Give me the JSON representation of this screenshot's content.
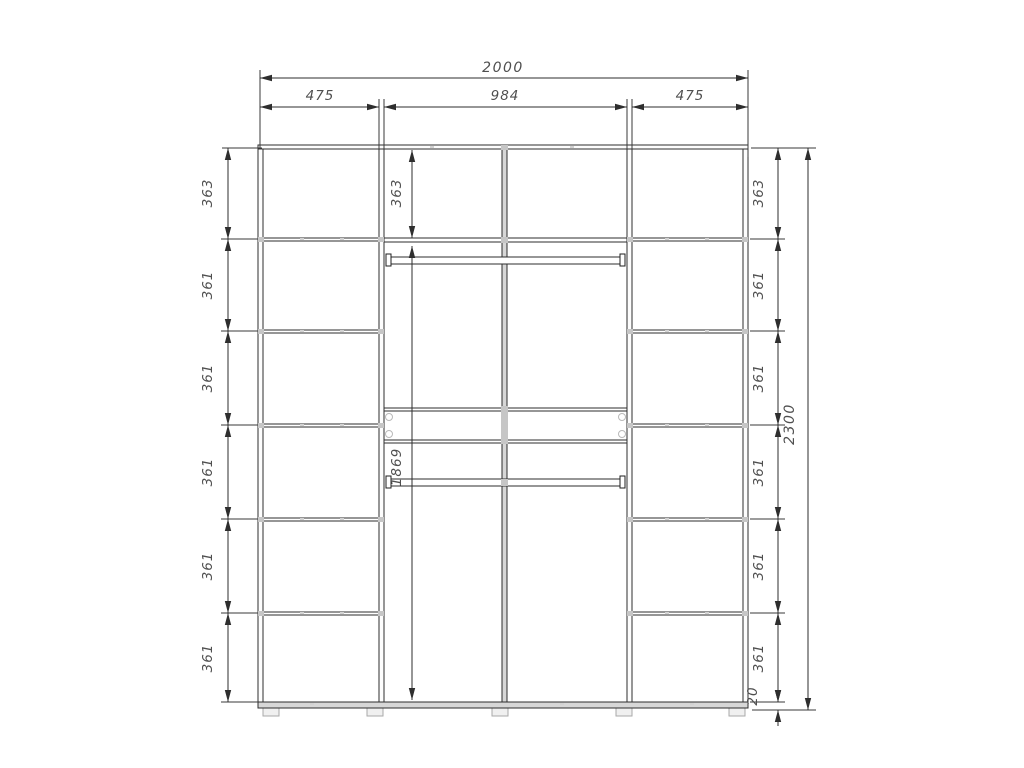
{
  "drawing": {
    "kind": "wardrobe-front-elevation",
    "units": "mm",
    "palette": {
      "background": "#ffffff",
      "line": "#2e2e2e",
      "dim_text": "#4f4f4f",
      "fitting_gray": "#c6c6c6"
    },
    "top_dims": {
      "total_width": "2000",
      "sections": [
        "475",
        "984",
        "475"
      ]
    },
    "left_dims": {
      "rows": [
        "363",
        "361",
        "361",
        "361",
        "361",
        "361"
      ]
    },
    "middle_dims": {
      "top": "363",
      "open_height": "1869"
    },
    "right_dims": {
      "rows": [
        "363",
        "361",
        "361",
        "361",
        "361",
        "361"
      ],
      "base": "20",
      "total_height": "2300"
    }
  }
}
